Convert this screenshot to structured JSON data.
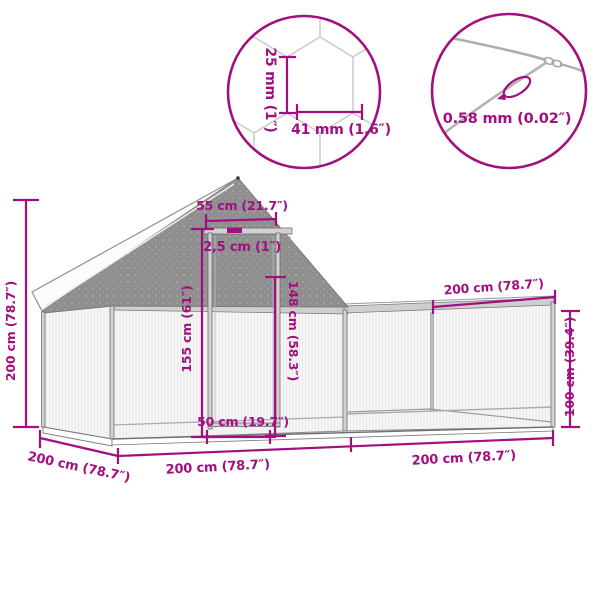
{
  "colors": {
    "dimension_accent": "#a1107e",
    "structure_outline": "#6f6f6f",
    "gable_mesh_gray": "#8f8f8f",
    "tube_fill": "#d2d2d2",
    "mesh_fill": "#f7f7f7",
    "roof_fill": "#fcfcfc"
  },
  "detail_circles": {
    "mesh": {
      "cell_height": "25 mm (1″)",
      "cell_width": "41 mm (1.6″)"
    },
    "wire": {
      "wire_thickness": "0.58 mm (0.02″)"
    }
  },
  "dimensions": {
    "coop_height": "200 cm (78.7″)",
    "roof_ridge_width": "55 cm (21.7″)",
    "frame_tube_width": "2,5 cm (1″)",
    "door_frame_height": "155 cm (61″)",
    "door_height": "148 cm (58.3″)",
    "door_width": "50 cm (19.7″)",
    "run_top_length": "200 cm (78.7″)",
    "run_height": "100 cm (39.4″)",
    "depth": "200 cm (78.7″)",
    "coop_section_length": "200 cm (78.7″)",
    "run_section_length": "200 cm (78.7″)"
  }
}
